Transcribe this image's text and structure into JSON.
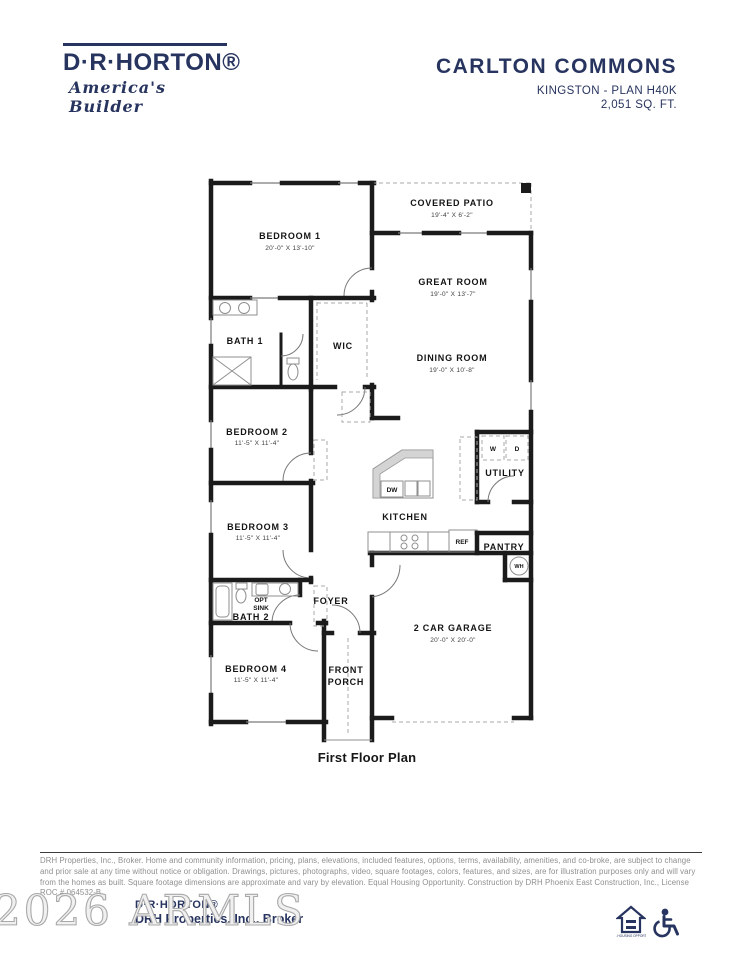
{
  "header": {
    "brand": "D·R·HORTON®",
    "tagline": "America's Builder",
    "community": "CARLTON COMMONS",
    "plan_name": "KINGSTON - PLAN H40K",
    "sqft": "2,051 SQ. FT."
  },
  "plan": {
    "caption": "First Floor Plan",
    "rooms": {
      "bedroom1": {
        "name": "BEDROOM 1",
        "dims": "20'-0\" X 13'-10\""
      },
      "covered_patio": {
        "name": "COVERED PATIO",
        "dims": "19'-4\" X 6'-2\""
      },
      "great_room": {
        "name": "GREAT ROOM",
        "dims": "19'-0\" X 13'-7\""
      },
      "dining_room": {
        "name": "DINING ROOM",
        "dims": "19'-0\" X 10'-8\""
      },
      "bath1": {
        "name": "BATH 1"
      },
      "wic": {
        "name": "WIC"
      },
      "bedroom2": {
        "name": "BEDROOM 2",
        "dims": "11'-5\" X 11'-4\""
      },
      "utility": {
        "name": "UTILITY"
      },
      "kitchen": {
        "name": "KITCHEN"
      },
      "bedroom3": {
        "name": "BEDROOM 3",
        "dims": "11'-5\" X 11'-4\""
      },
      "pantry": {
        "name": "PANTRY"
      },
      "bath2": {
        "name": "BATH 2"
      },
      "foyer": {
        "name": "FOYER"
      },
      "bedroom4": {
        "name": "BEDROOM 4",
        "dims": "11'-5\" X 11'-4\""
      },
      "front_porch": {
        "line1": "FRONT",
        "line2": "PORCH"
      },
      "garage": {
        "name": "2 CAR GARAGE",
        "dims": "20'-0\" X 20'-0\""
      }
    },
    "labels": {
      "dw": "DW",
      "washer": "W",
      "dryer": "D",
      "ref": "REF",
      "wh": "WH",
      "opt_line1": "OPT",
      "opt_line2": "SINK"
    }
  },
  "footer": {
    "disclaimer": "DRH Properties, Inc., Broker. Home and community information, pricing, plans, elevations, included features, options, terms, availability, amenities, and co-broke, are subject to change and prior sale at any time without notice or obligation. Drawings, pictures, photographs, video, square footages, colors, features, and sizes, are for illustration purposes only and will vary from the homes as built. Square footage dimensions are approximate and vary by elevation. Equal Housing Opportunity. Construction by DRH Phoenix East Construction, Inc., License ROC # 064532-B.",
    "watermark": "2026 ARMLS",
    "brand_small": "D·R·HORTON®",
    "broker": "DRH Properties, Inc., Broker",
    "equal_housing_label": "EQUAL HOUSING OPPORTUNITY"
  },
  "colors": {
    "navy": "#27345F",
    "wall": "#1b1b1b",
    "gray_line": "#8f8f8f"
  }
}
